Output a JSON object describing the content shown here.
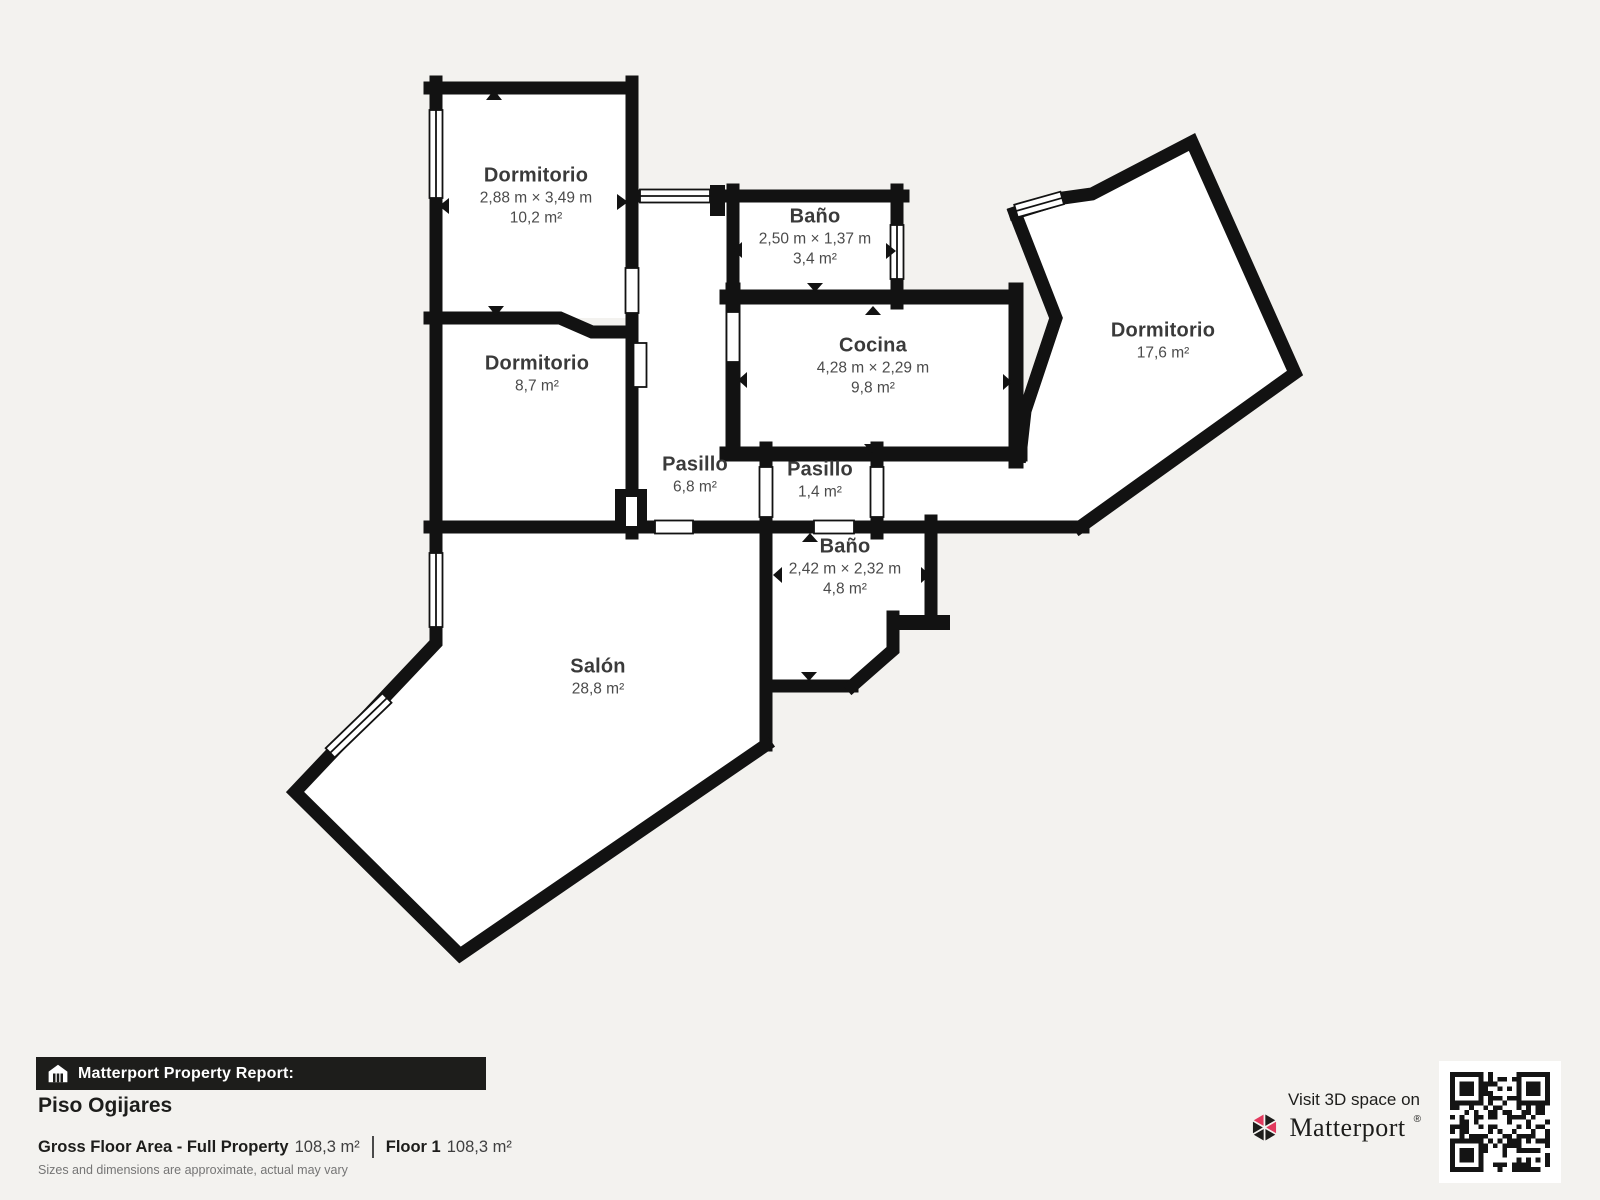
{
  "theme": {
    "background": "#f3f2ef",
    "wall_color": "#121212",
    "room_fill": "#ffffff",
    "text_dark": "#1d1d1b",
    "text_room": "#3a3a3a",
    "text_muted": "#757575",
    "brand_pink": "#e23a5e"
  },
  "plan": {
    "rooms": [
      {
        "id": "dormitorio-1",
        "name": "Dormitorio",
        "dims": "2,88 m × 3,49 m",
        "area": "10,2 m²"
      },
      {
        "id": "bano-1",
        "name": "Baño",
        "dims": "2,50 m × 1,37 m",
        "area": "3,4 m²"
      },
      {
        "id": "dormitorio-2",
        "name": "Dormitorio",
        "dims": "",
        "area": "8,7 m²"
      },
      {
        "id": "cocina",
        "name": "Cocina",
        "dims": "4,28 m × 2,29 m",
        "area": "9,8 m²"
      },
      {
        "id": "pasillo-1",
        "name": "Pasillo",
        "dims": "",
        "area": "6,8 m²"
      },
      {
        "id": "pasillo-2",
        "name": "Pasillo",
        "dims": "",
        "area": "1,4 m²"
      },
      {
        "id": "bano-2",
        "name": "Baño",
        "dims": "2,42 m × 2,32 m",
        "area": "4,8 m²"
      },
      {
        "id": "dormitorio-3",
        "name": "Dormitorio",
        "dims": "",
        "area": "17,6 m²"
      },
      {
        "id": "salon",
        "name": "Salón",
        "dims": "",
        "area": "28,8 m²"
      }
    ]
  },
  "footer": {
    "report_label": "Matterport Property Report:",
    "property_name": "Piso Ogijares",
    "gross_label": "Gross Floor Area - Full Property",
    "gross_value": "108,3 m²",
    "floor_label": "Floor 1",
    "floor_value": "108,3 m²",
    "disclaimer": "Sizes and dimensions are approximate, actual may vary"
  },
  "cta": {
    "visit_text": "Visit 3D space on",
    "brand": "Matterport",
    "trademark": "®"
  }
}
